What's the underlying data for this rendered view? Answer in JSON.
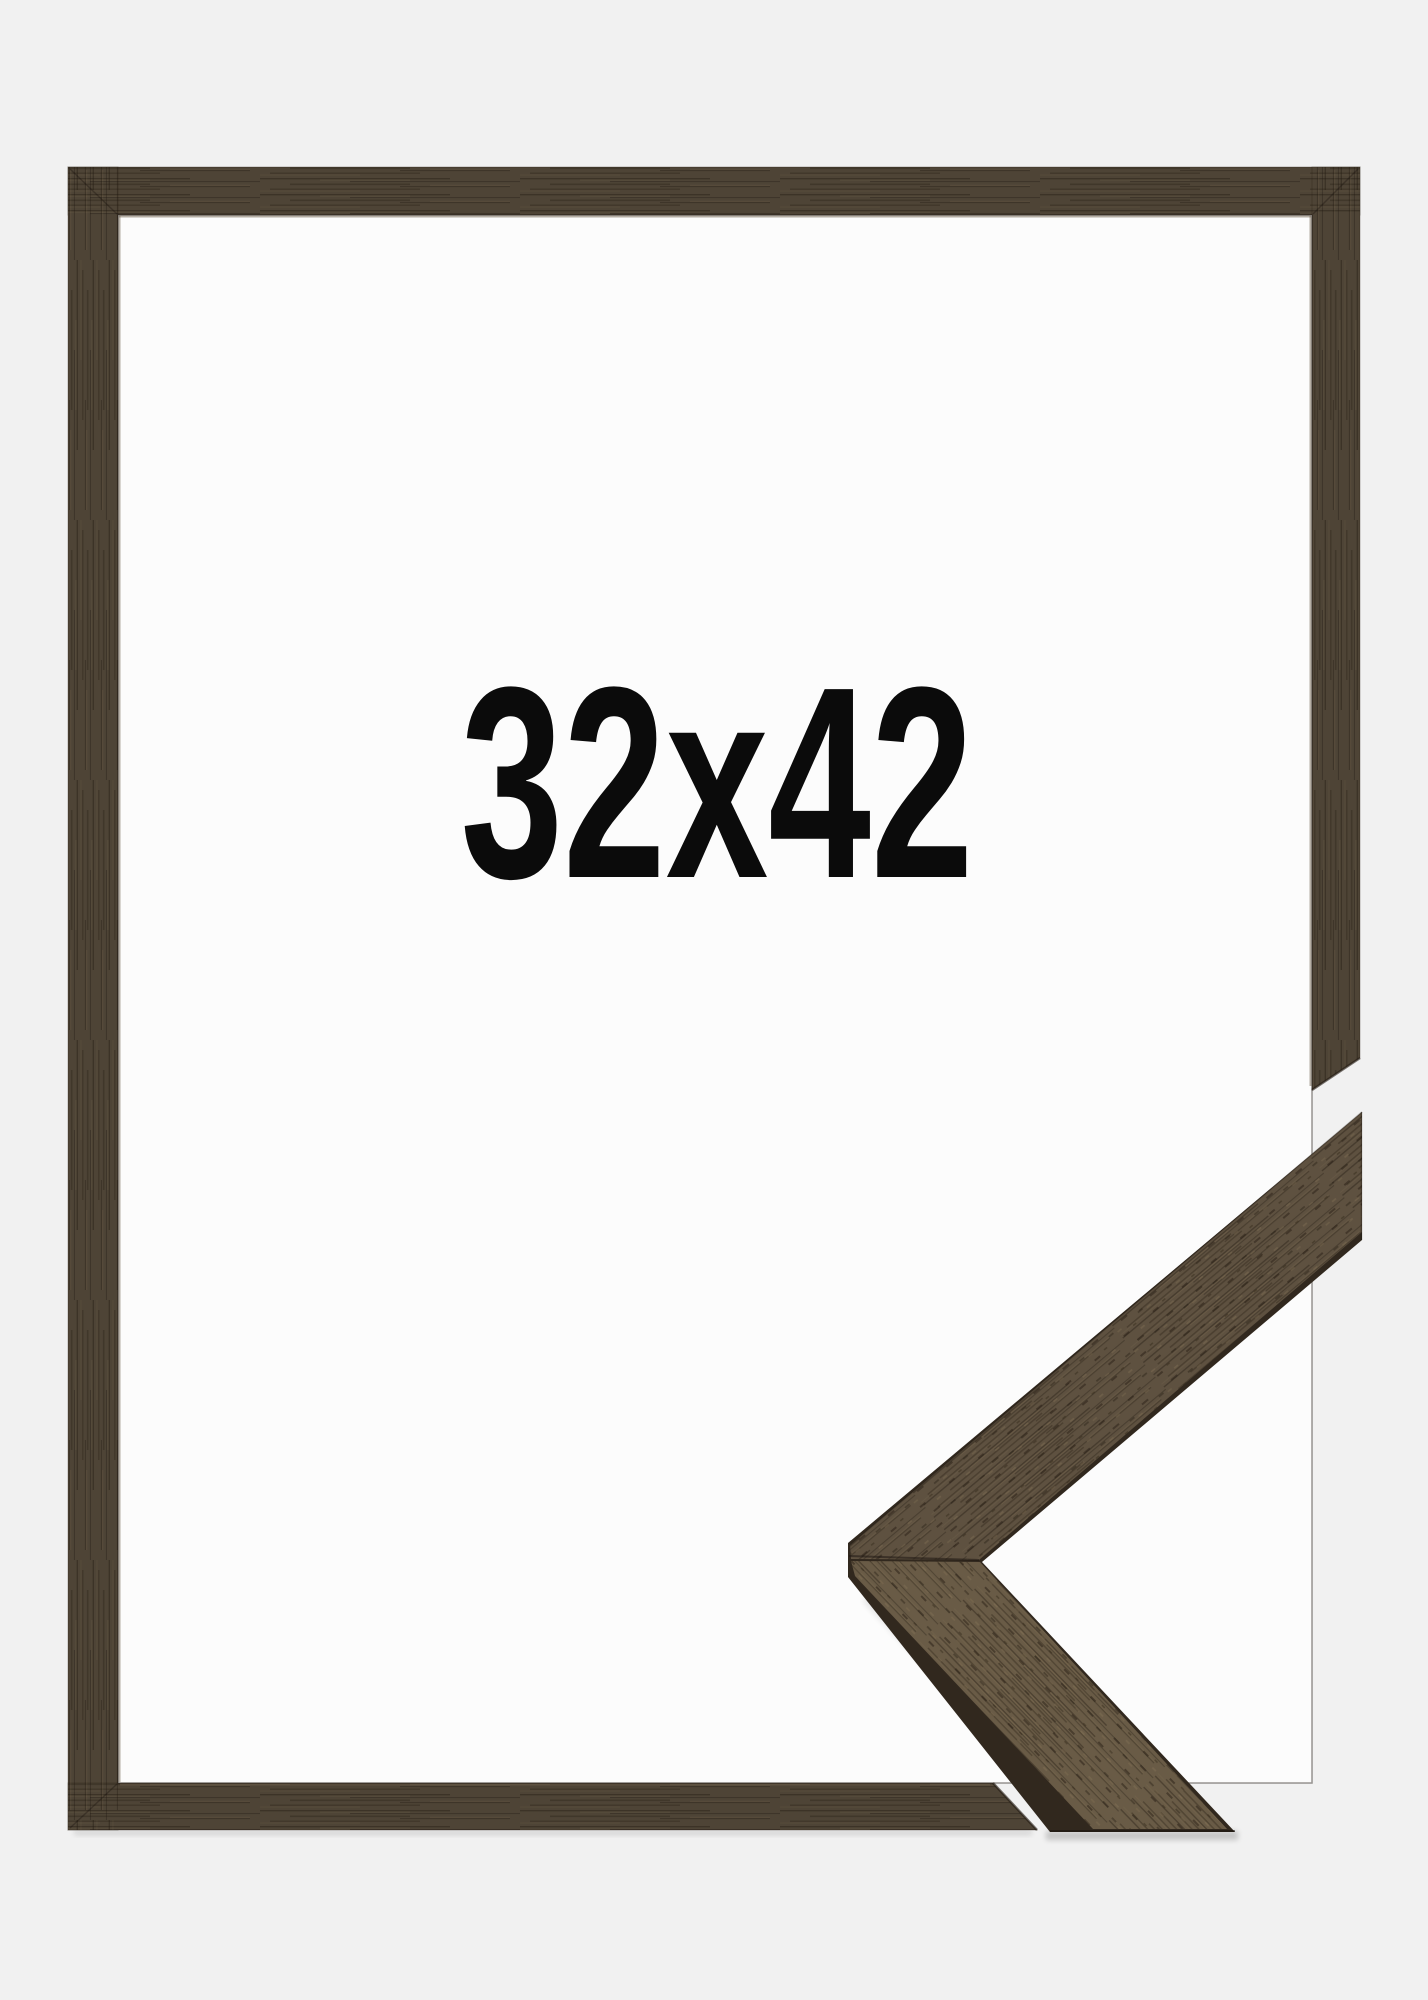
{
  "product": {
    "size_label": "32x42"
  },
  "colors": {
    "background": "#f1f1f1",
    "frame_backing": "#fcfcfc",
    "frame_wood": "#4e4436",
    "sample_side": "#31281e",
    "sample_top_arm": "#5e5140",
    "sample_bottom_arm": "#695b46",
    "label_text": "#0b0b0b"
  }
}
